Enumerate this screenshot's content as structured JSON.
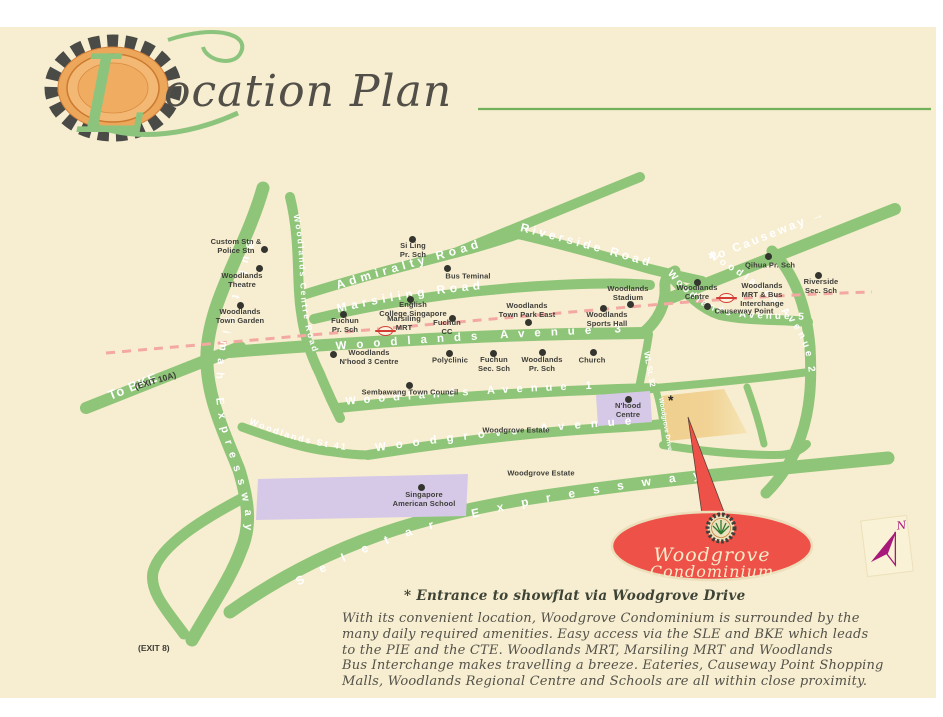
{
  "header": {
    "title_initial": "L",
    "title_rest": "ocation Plan"
  },
  "map": {
    "roads": {
      "bke": "Bukit Timah Expressway",
      "to_bke": "To BKE",
      "exit_10a": "(EXIT 10A)",
      "exit_8": "(EXIT 8)",
      "woodlands_centre_road": "Woodlands Centre Road",
      "admiralty_road": "Admiralty Road",
      "marsiling_road": "Marsiling Road",
      "riverside_road": "Riverside Road",
      "to_causeway": "To Causeway →",
      "woodlands_ave_3": "Woodlands Avenue 3",
      "woodlands_ave_5": "Woodlands Avenue 5",
      "woodlands_ave_2": "Woodlands Avenue 2",
      "woodlands_ave_1": "Woodlands Avenue 1",
      "wl_st_32": "WL St. 32",
      "woodlands_st_41": "Woodlands St 41",
      "woodgrove_avenue": "Woodgrove Avenue",
      "woodgrove_drive": "Woodgrove Drive",
      "seletar_expressway": "Seletar Expressway"
    },
    "landmarks": [
      {
        "label": "Custom Stn &\nPolice Stn",
        "lx": 236,
        "ly": 247,
        "dot": [
          264,
          249
        ]
      },
      {
        "label": "Woodlands\nTheatre",
        "lx": 242,
        "ly": 281,
        "dot": [
          259,
          268
        ]
      },
      {
        "label": "Woodlands\nTown Garden",
        "lx": 240,
        "ly": 317,
        "dot": [
          240,
          305
        ]
      },
      {
        "label": "Si Ling\nPr. Sch",
        "lx": 413,
        "ly": 251,
        "dot": [
          412,
          239
        ]
      },
      {
        "label": "Bus Teminal",
        "lx": 468,
        "ly": 277,
        "dot": [
          447,
          268
        ]
      },
      {
        "label": "English\nCollege Singapore",
        "lx": 413,
        "ly": 310,
        "dot": [
          410,
          299
        ]
      },
      {
        "label": "Fuchun\nPr. Sch",
        "lx": 345,
        "ly": 326,
        "dot": [
          343,
          314
        ]
      },
      {
        "label": "Marsiling\nMRT",
        "lx": 404,
        "ly": 324,
        "mrt": [
          385,
          331
        ]
      },
      {
        "label": "Fuchun\nCC",
        "lx": 447,
        "ly": 328,
        "dot": [
          452,
          318
        ]
      },
      {
        "label": "Woodlands\nTown Park East",
        "lx": 527,
        "ly": 311,
        "dot": [
          528,
          322
        ]
      },
      {
        "label": "Woodlands\nStadium",
        "lx": 628,
        "ly": 294,
        "dot": [
          630,
          304
        ]
      },
      {
        "label": "Woodlands\nSports Hall",
        "lx": 607,
        "ly": 320,
        "dot": [
          603,
          308
        ]
      },
      {
        "label": "Woodlands\nCentre",
        "lx": 697,
        "ly": 293,
        "dot": [
          697,
          282
        ]
      },
      {
        "label": "Woodlands\nMRT & Bus\nInterchange",
        "lx": 762,
        "ly": 295,
        "mrt": [
          726,
          298
        ]
      },
      {
        "label": "Causeway Point",
        "lx": 744,
        "ly": 312,
        "dot": [
          707,
          306
        ]
      },
      {
        "label": "Qihua Pr. Sch",
        "lx": 770,
        "ly": 266,
        "dot": [
          768,
          256
        ]
      },
      {
        "label": "Riverside\nSec. Sch",
        "lx": 821,
        "ly": 287,
        "dot": [
          818,
          275
        ]
      },
      {
        "label": "Woodlands\nN'hood 3 Centre",
        "lx": 369,
        "ly": 358,
        "dot": [
          333,
          354
        ]
      },
      {
        "label": "Polyclinic",
        "lx": 450,
        "ly": 361,
        "dot": [
          449,
          353
        ]
      },
      {
        "label": "Fuchun\nSec. Sch",
        "lx": 494,
        "ly": 365,
        "dot": [
          493,
          353
        ]
      },
      {
        "label": "Woodlands\nPr. Sch",
        "lx": 542,
        "ly": 365,
        "dot": [
          542,
          352
        ]
      },
      {
        "label": "Church",
        "lx": 592,
        "ly": 361,
        "dot": [
          593,
          352
        ]
      },
      {
        "label": "Sembawang Town Council",
        "lx": 410,
        "ly": 393,
        "dot": [
          409,
          385
        ]
      },
      {
        "label": "N'hood\nCentre",
        "lx": 628,
        "ly": 411,
        "dot": [
          628,
          399
        ]
      },
      {
        "label": "Woodgrove Estate",
        "lx": 516,
        "ly": 431
      },
      {
        "label": "Woodgrove Estate",
        "lx": 541,
        "ly": 474
      },
      {
        "label": "Singapore\nAmerican School",
        "lx": 424,
        "ly": 500,
        "dot": [
          421,
          487
        ]
      }
    ],
    "site": {
      "marker": "*"
    },
    "callout": {
      "name_line1": "Woodgrove",
      "name_line2": "Condominium"
    },
    "compass": {
      "north": "N"
    },
    "notes": {
      "entrance": "*  Entrance to showflat via Woodgrove Drive",
      "description": "With its convenient location, Woodgrove Condominium is surrounded by the\nmany daily required amenities. Easy access via the SLE and BKE which leads\nto the PIE and the CTE. Woodlands MRT, Marsiling MRT and Woodlands\nBus Interchange makes travelling a breeze. Eateries, Causeway Point Shopping\nMalls, Woodlands Regional Centre and Schools are all within close proximity."
    },
    "colors": {
      "road_green": "#8fc578",
      "railway_pink": "#f3a9a2",
      "site_yellow": "#f0cf8e",
      "school_purple": "#d6c9e8",
      "callout_red": "#ee5148",
      "compass_magenta": "#a8187b",
      "page_cream": "#f7edd0"
    }
  }
}
